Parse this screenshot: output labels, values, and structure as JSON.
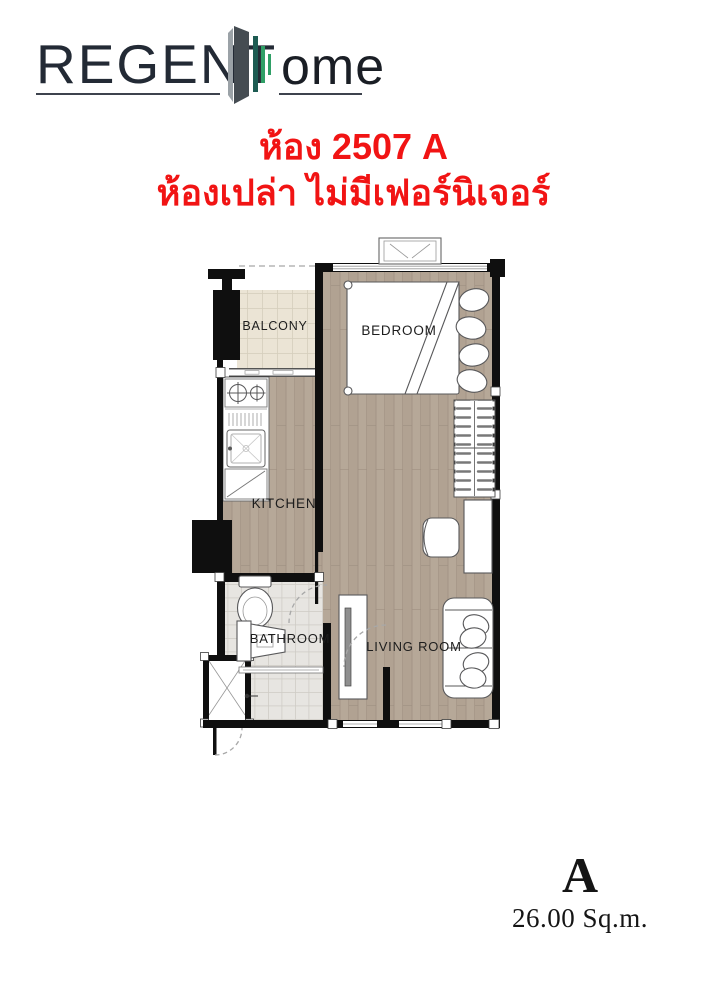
{
  "logo": {
    "brand_part1": "REGENT",
    "brand_part2": "ome",
    "icon": "building-skyline-icon"
  },
  "title": {
    "room_line": "ห้อง 2507 A",
    "condition_line": "ห้องเปล่า ไม่มีเฟอร์นิเจอร์"
  },
  "floorplan": {
    "labels": {
      "balcony": "BALCONY",
      "bedroom": "BEDROOM",
      "kitchen": "KITCHEN",
      "bathroom": "BATHROOM",
      "living_room": "LIVING ROOM"
    }
  },
  "unit": {
    "type": "A",
    "area": "26.00 Sq.m."
  },
  "colors": {
    "red": "#f11414",
    "logo-text": "#232a35",
    "underline": "#3d434d",
    "tower": "#454c52",
    "tower-side": "#9ba2a7",
    "bar-teal": "#1d5b52",
    "bar-green": "#2f9f66",
    "wall": "#0f0f0f",
    "wood": "#b6a898",
    "wood-alt": "#ab9c8c",
    "wood-line": "#9d8f80",
    "btile": "#ebe4d5",
    "btile-grid": "#d5cebc",
    "bathtile": "#e7e5e1",
    "bathtile-grid": "#cfccc6",
    "stroke": "#58585a",
    "ink": "#151515"
  }
}
